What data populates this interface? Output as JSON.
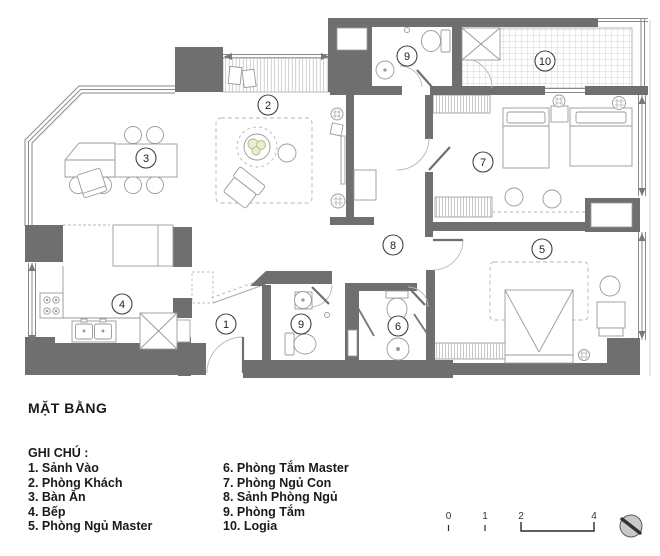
{
  "title": "MẶT BẰNG",
  "legend": {
    "heading": "GHI CHÚ :",
    "col1": [
      "1. Sảnh Vào",
      "2. Phòng Khách",
      "3. Bàn Ăn",
      "4. Bếp",
      "5. Phòng Ngủ Master"
    ],
    "col2": [
      "6. Phòng Tắm Master",
      "7. Phòng Ngủ Con",
      "8. Sảnh Phòng Ngủ",
      "9. Phòng Tắm",
      "10. Logia"
    ]
  },
  "markers": [
    "1",
    "2",
    "3",
    "4",
    "5",
    "6",
    "7",
    "8",
    "9",
    "9",
    "10"
  ],
  "scalebar": {
    "labels": [
      "0",
      "1",
      "2",
      "4"
    ]
  },
  "colors": {
    "wall": "#6f6f6f",
    "furniture_line": "#9a9a9a",
    "hatch": "#c0c0c0",
    "plant_green": "#adc078",
    "text": "#1a1a1a"
  }
}
